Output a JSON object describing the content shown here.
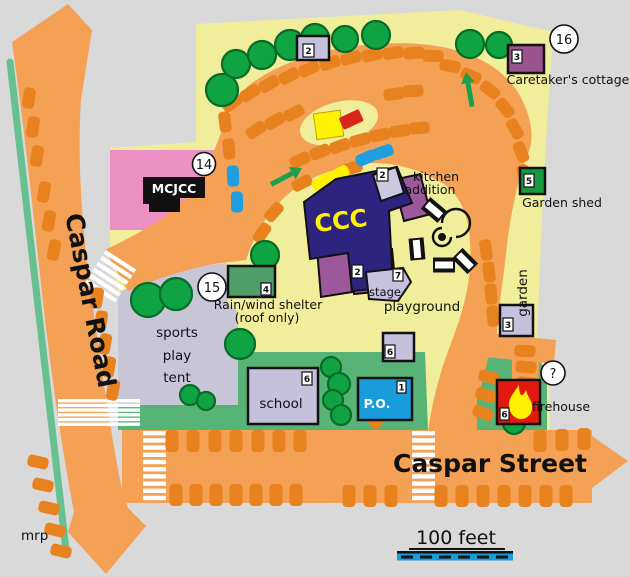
{
  "map": {
    "streets": {
      "caspar_road": "Caspar Road",
      "caspar_street": "Caspar Street",
      "mrp": "mrp"
    },
    "scale": {
      "label": "100 feet"
    },
    "markers": {
      "m14": "14",
      "m15": "15",
      "m16": "16",
      "unknown": "?"
    },
    "labels": {
      "mcjcc": "MCJCC",
      "ccc": "CCC",
      "kitchen_line1": "kitchen",
      "kitchen_line2": "addition",
      "stage": "stage",
      "playground": "playground",
      "garden": "garden",
      "garden_shed": "Garden shed",
      "caretakers_cottage": "Caretaker's cottage",
      "rain_shelter_line1": "Rain/wind shelter",
      "rain_shelter_line2": "(roof only)",
      "sports_line1": "sports",
      "sports_line2": "play",
      "sports_line3": "tent",
      "school": "school",
      "po": "P.O.",
      "firehouse": "firehouse"
    },
    "door_numbers": {
      "top_shed": "2",
      "caretakers_cottage": "3",
      "garden_shed": "5",
      "kitchen": "2",
      "ccc_south": "2",
      "stage": "7",
      "rain_shelter": "4",
      "school": "6",
      "po": "1",
      "east_shed": "3",
      "playground_shed": "6",
      "firehouse": "6"
    },
    "colors": {
      "background": "#d9d9d9",
      "campus_yellow": "#F0EE9A",
      "road_orange": "#F4A055",
      "parking_spot_orange": "#E8821F",
      "lawn_green": "#58B377",
      "tree_green": "#10A341",
      "mcjcc_pink": "#EC8FC2",
      "ccc_navy": "#2F2380",
      "ccc_purple": "#9C589B",
      "building_lavender": "#C5C0DC",
      "po_blue": "#189CDC",
      "firehouse_red": "#E01A0E",
      "shelter_green": "#4F9E69",
      "garden_shed_green": "#17993F",
      "caretaker_purple": "#99538F",
      "highlight_yellow": "#FFF200"
    }
  }
}
